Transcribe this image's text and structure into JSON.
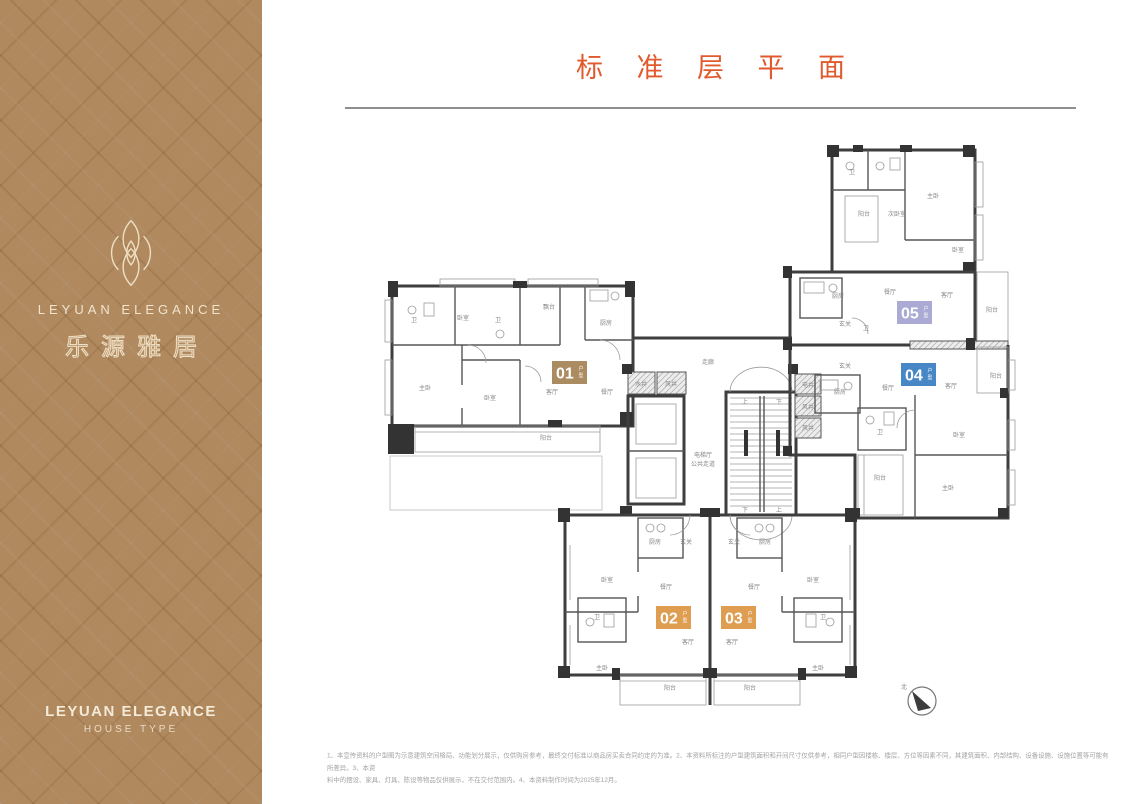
{
  "header": {
    "title": "标 准 层 平 面"
  },
  "sidebar": {
    "brand_en": "LEYUAN ELEGANCE",
    "brand_cn": "乐源雅居",
    "footer_en": "LEYUAN ELEGANCE",
    "footer_sub": "HOUSE TYPE"
  },
  "plan": {
    "compass_label": "北",
    "badges": [
      {
        "id": "01",
        "suffix": "户型",
        "color": "#ab8b60",
        "x": 552,
        "y": 361
      },
      {
        "id": "02",
        "suffix": "户型",
        "color": "#df9d52",
        "x": 656,
        "y": 606
      },
      {
        "id": "03",
        "suffix": "户型",
        "color": "#df9d52",
        "x": 721,
        "y": 606
      },
      {
        "id": "04",
        "suffix": "户型",
        "color": "#4787c6",
        "x": 901,
        "y": 363
      },
      {
        "id": "05",
        "suffix": "户型",
        "color": "#abaad4",
        "x": 897,
        "y": 301
      }
    ],
    "room_labels": [
      {
        "t": "卫",
        "x": 414,
        "y": 322
      },
      {
        "t": "卧室",
        "x": 463,
        "y": 320
      },
      {
        "t": "卫",
        "x": 498,
        "y": 322
      },
      {
        "t": "飘台",
        "x": 549,
        "y": 309
      },
      {
        "t": "厨房",
        "x": 606,
        "y": 325
      },
      {
        "t": "主卧",
        "x": 425,
        "y": 390
      },
      {
        "t": "卧室",
        "x": 490,
        "y": 400
      },
      {
        "t": "客厅",
        "x": 552,
        "y": 394
      },
      {
        "t": "餐厅",
        "x": 607,
        "y": 394
      },
      {
        "t": "阳台",
        "x": 546,
        "y": 440
      },
      {
        "t": "走廊",
        "x": 708,
        "y": 364
      },
      {
        "t": "水井",
        "x": 641,
        "y": 386
      },
      {
        "t": "风井",
        "x": 671,
        "y": 386
      },
      {
        "t": "电井",
        "x": 808,
        "y": 387
      },
      {
        "t": "风井",
        "x": 808,
        "y": 409
      },
      {
        "t": "风井",
        "x": 808,
        "y": 430
      },
      {
        "t": "电梯厅",
        "x": 703,
        "y": 457
      },
      {
        "t": "公共走道",
        "x": 703,
        "y": 466
      },
      {
        "t": "上",
        "x": 745,
        "y": 404
      },
      {
        "t": "下",
        "x": 779,
        "y": 404
      },
      {
        "t": "下",
        "x": 745,
        "y": 512
      },
      {
        "t": "上",
        "x": 779,
        "y": 512
      },
      {
        "t": "卫",
        "x": 852,
        "y": 174
      },
      {
        "t": "主卧",
        "x": 933,
        "y": 198
      },
      {
        "t": "阳台",
        "x": 864,
        "y": 216
      },
      {
        "t": "次卧室",
        "x": 897,
        "y": 216
      },
      {
        "t": "卧室",
        "x": 958,
        "y": 252
      },
      {
        "t": "卫",
        "x": 866,
        "y": 330
      },
      {
        "t": "厨房",
        "x": 838,
        "y": 298
      },
      {
        "t": "餐厅",
        "x": 890,
        "y": 294
      },
      {
        "t": "客厅",
        "x": 947,
        "y": 297
      },
      {
        "t": "玄关",
        "x": 845,
        "y": 326
      },
      {
        "t": "阳台",
        "x": 992,
        "y": 312
      },
      {
        "t": "玄关",
        "x": 845,
        "y": 368
      },
      {
        "t": "厨房",
        "x": 840,
        "y": 394
      },
      {
        "t": "餐厅",
        "x": 888,
        "y": 390
      },
      {
        "t": "客厅",
        "x": 951,
        "y": 388
      },
      {
        "t": "阳台",
        "x": 996,
        "y": 378
      },
      {
        "t": "卫",
        "x": 880,
        "y": 434
      },
      {
        "t": "卧室",
        "x": 959,
        "y": 437
      },
      {
        "t": "阳台",
        "x": 880,
        "y": 480
      },
      {
        "t": "主卧",
        "x": 948,
        "y": 490
      },
      {
        "t": "厨房",
        "x": 655,
        "y": 544
      },
      {
        "t": "玄关",
        "x": 686,
        "y": 544
      },
      {
        "t": "卧室",
        "x": 607,
        "y": 582
      },
      {
        "t": "餐厅",
        "x": 666,
        "y": 589
      },
      {
        "t": "卫",
        "x": 597,
        "y": 619
      },
      {
        "t": "客厅",
        "x": 688,
        "y": 644
      },
      {
        "t": "主卧",
        "x": 602,
        "y": 670
      },
      {
        "t": "阳台",
        "x": 670,
        "y": 690
      },
      {
        "t": "玄关",
        "x": 734,
        "y": 544
      },
      {
        "t": "厨房",
        "x": 765,
        "y": 544
      },
      {
        "t": "卧室",
        "x": 813,
        "y": 582
      },
      {
        "t": "餐厅",
        "x": 754,
        "y": 589
      },
      {
        "t": "卫",
        "x": 823,
        "y": 619
      },
      {
        "t": "客厅",
        "x": 732,
        "y": 644
      },
      {
        "t": "主卧",
        "x": 818,
        "y": 670
      },
      {
        "t": "阳台",
        "x": 750,
        "y": 690
      }
    ]
  },
  "footnote": {
    "line1": "1、本宣传资料的户型图为示意建筑空间格局、功能划分展示，仅供购房参考，最终交付标准以商品房买卖合同约定的为准。2、本资料所标注的户型建筑面积和开间尺寸仅供参考，相同户型因楼栋、楼层、方位等因素不同，其建筑面积、内部结构、设备设施、设施位置等可能有所差异。3、本资",
    "line2": "料中的摆设、家具、灯具、陈设等物品仅供展示，不在交付范围内。4、本资料制作时间为2025年12月。"
  }
}
